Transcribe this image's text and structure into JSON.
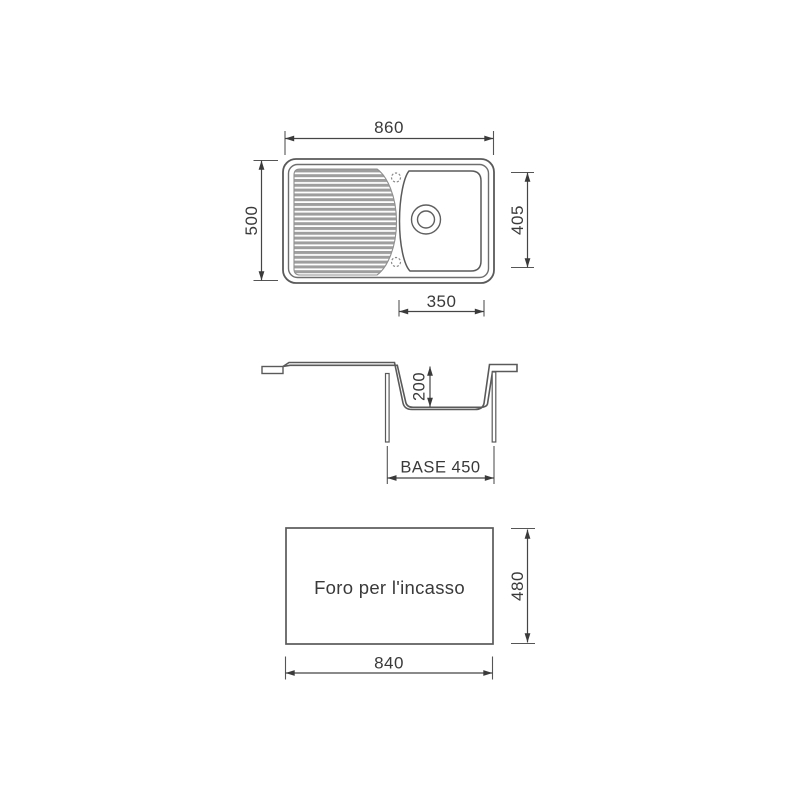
{
  "drawing": {
    "top_view": {
      "overall_width": "860",
      "overall_depth": "500",
      "bowl_length": "405",
      "bowl_width": "350"
    },
    "section_view": {
      "bowl_depth": "200",
      "base": "BASE 450"
    },
    "cutout_view": {
      "label": "Foro per l'incasso",
      "width": "840",
      "height": "480"
    }
  },
  "colors": {
    "background": "#ffffff",
    "main_line": "#5a5a5a",
    "dimension_line": "#454545",
    "text": "#3a3a3a",
    "drainer_ribs": "#9e9e9e"
  }
}
